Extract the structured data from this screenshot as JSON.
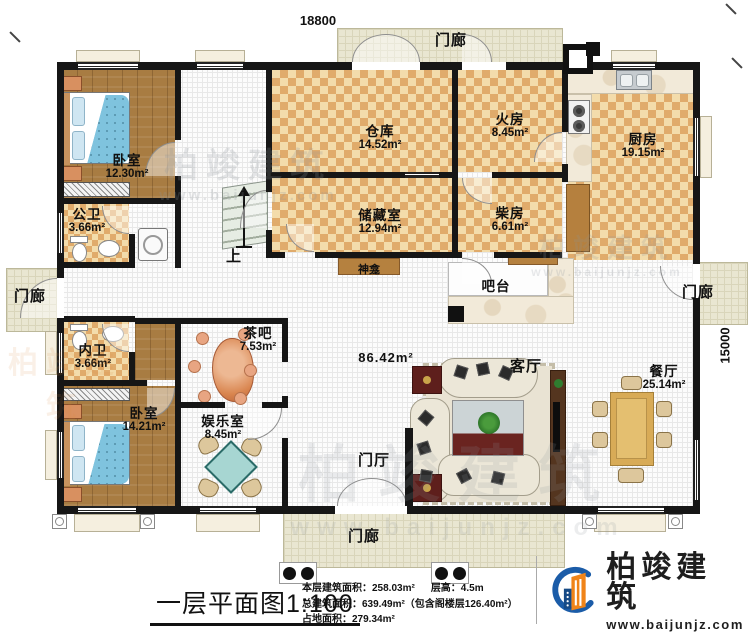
{
  "dimensions": {
    "width": "18800",
    "height": "15000"
  },
  "rooms": {
    "bedroom1": {
      "label": "卧室",
      "area": "12.30m²"
    },
    "public_bath": {
      "label": "公卫",
      "area": "3.66m²"
    },
    "warehouse": {
      "label": "仓库",
      "area": "14.52m²"
    },
    "fire_room": {
      "label": "火房",
      "area": "8.45m²"
    },
    "kitchen": {
      "label": "厨房",
      "area": "19.15m²"
    },
    "storage": {
      "label": "储藏室",
      "area": "12.94m²"
    },
    "firewood_room": {
      "label": "柴房",
      "area": "6.61m²"
    },
    "inner_bath": {
      "label": "内卫",
      "area": "3.66m²"
    },
    "tea_bar": {
      "label": "茶吧",
      "area": "7.53m²"
    },
    "bedroom2": {
      "label": "卧室",
      "area": "14.21m²"
    },
    "rec_room": {
      "label": "娱乐室",
      "area": "8.45m²"
    },
    "living_room": {
      "label": "客厅"
    },
    "dining_room": {
      "label": "餐厅",
      "area": "25.14m²"
    },
    "hall": {
      "area": "86.42m²"
    },
    "foyer": {
      "label": "门厅"
    },
    "shrine": {
      "label": "神龛"
    },
    "bar_counter": {
      "label": "吧台"
    },
    "porch_top": {
      "label": "门廊"
    },
    "porch_left": {
      "label": "门廊"
    },
    "porch_right": {
      "label": "门廊"
    },
    "porch_bottom": {
      "label": "门廊"
    }
  },
  "stairs": {
    "up_label": "上"
  },
  "footer": {
    "title": "一层平面图1:100",
    "stats": {
      "floor_area": "本层建筑面积：258.03m²",
      "floor_height": "层高：4.5m",
      "total_area": "总建筑面积：639.49m²（包含阁楼层126.40m²）",
      "land_area": "占地面积：279.34m²"
    }
  },
  "brand": {
    "name": "柏竣建筑",
    "website": "www.baijunjz.com",
    "blue": "#1b5ca8",
    "orange": "#f08419"
  },
  "watermark": {
    "text": "柏竣建筑",
    "url": "www.baijunjz.com"
  },
  "colors": {
    "wall": "#161616",
    "room_checker": "#e8c184",
    "wood_floor": "#a87c42",
    "bed_blue": "#7fc3de",
    "porch": "#e9e6d1"
  }
}
